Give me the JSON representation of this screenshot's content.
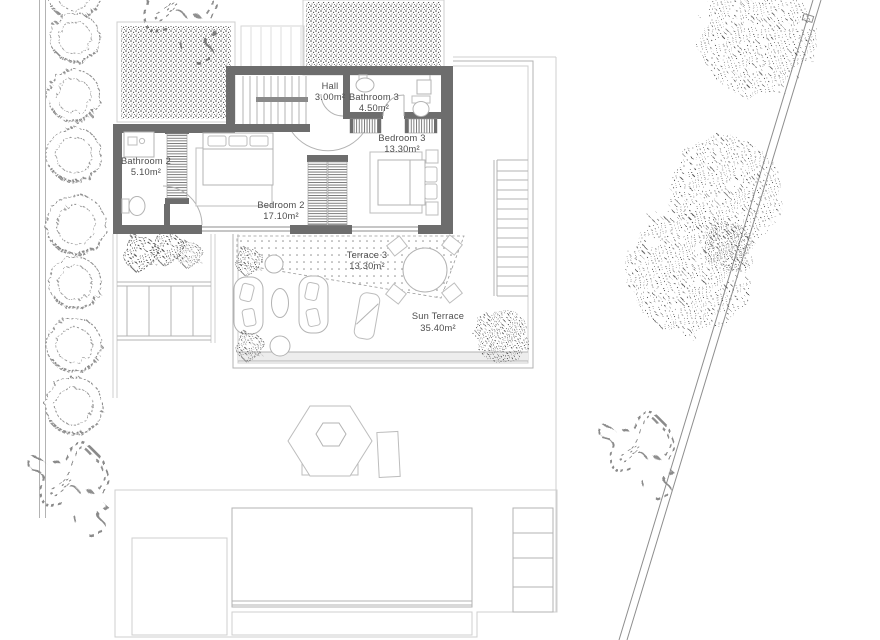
{
  "document": {
    "type": "architectural-floor-plan",
    "view": "upper floor with sun terrace, garden and pool"
  },
  "rooms": [
    {
      "id": "hall",
      "name": "Hall",
      "area": "3.00m²"
    },
    {
      "id": "bathroom-3",
      "name": "Bathroom 3",
      "area": "4.50m²"
    },
    {
      "id": "bedroom-3",
      "name": "Bedroom 3",
      "area": "13.30m²"
    },
    {
      "id": "bathroom-2",
      "name": "Bathroom 2",
      "area": "5.10m²"
    },
    {
      "id": "bedroom-2",
      "name": "Bedroom 2",
      "area": "17.10m²"
    },
    {
      "id": "terrace-3",
      "name": "Terrace 3",
      "area": "13.30m²"
    },
    {
      "id": "sun-terrace",
      "name": "Sun Terrace",
      "area": "35.40m²"
    }
  ],
  "colors": {
    "wall": "#6d6d6d",
    "faint_line": "#cfcfcf",
    "mid_line": "#b3b3b3",
    "text": "#4d4d4d",
    "speckle": "#3d3d3d"
  }
}
